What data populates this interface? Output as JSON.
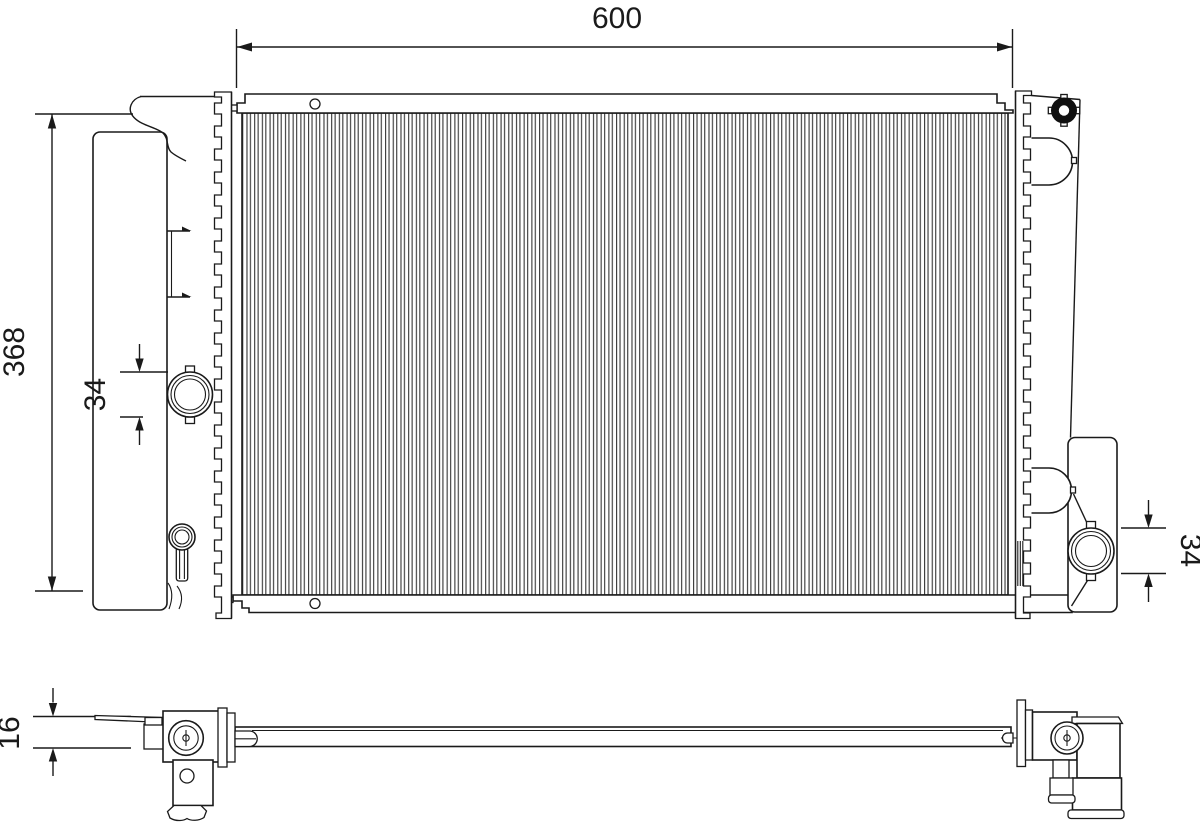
{
  "drawing": {
    "title": "radiator-dimensional-drawing",
    "views": [
      "front-view",
      "bottom-view"
    ],
    "dimensions": {
      "width": "600",
      "height": "368",
      "inlet": "34",
      "outlet": "34",
      "thickness": "16"
    }
  }
}
